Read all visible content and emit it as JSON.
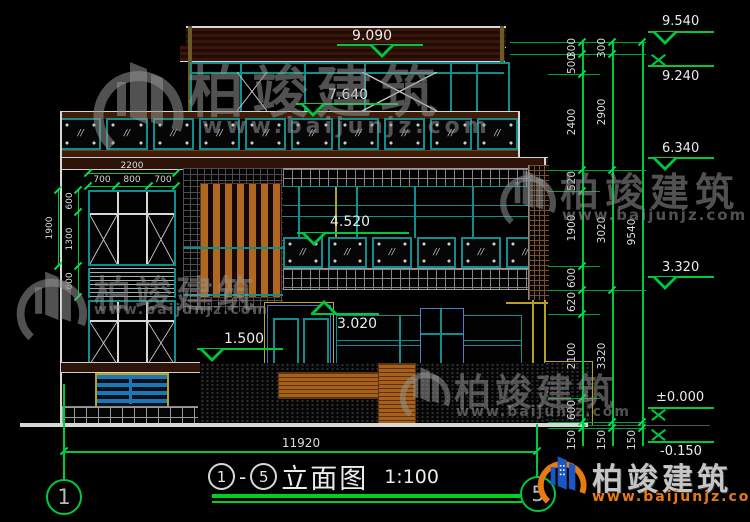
{
  "watermark": {
    "brand": "柏竣建筑",
    "site": "www.baijunjz.com"
  },
  "levels_right": [
    "9.540",
    "9.240",
    "6.340",
    "3.320",
    "±0.000",
    "-0.150"
  ],
  "levels_plan": {
    "roof": "9.090",
    "penthouse": "7.640",
    "floor2": "4.520",
    "window1f": "3.020",
    "entry": "1.500"
  },
  "dims": {
    "right_inner": [
      "300",
      "500",
      "2400",
      "520",
      "1900",
      "600",
      "620",
      "2100",
      "600",
      "150"
    ],
    "right_mid": [
      "300",
      "2900",
      "3020",
      "3320",
      "150"
    ],
    "right_outer": [
      "9540",
      "150"
    ],
    "left_total": "1900",
    "left_parts": [
      "600",
      "1300",
      "600"
    ],
    "win_total": "2200",
    "win_parts": [
      "700",
      "800",
      "700"
    ],
    "bottom_total": "11920"
  },
  "title": {
    "axis_from": "1",
    "sep": "-",
    "axis_to": "5",
    "name": "立面图",
    "scale": "1:100"
  },
  "axes": {
    "left": "1",
    "right": "5"
  },
  "glass_mark": "//",
  "colors": {
    "dim_green": "#00c83c",
    "frame_teal": "#0e8f8f",
    "wood_orange": "#b06820",
    "trim_yellow": "#b8a020",
    "door_blue": "#3d74c9",
    "logo_orange": "#e87b10",
    "logo_blue": "#1a57c5"
  }
}
